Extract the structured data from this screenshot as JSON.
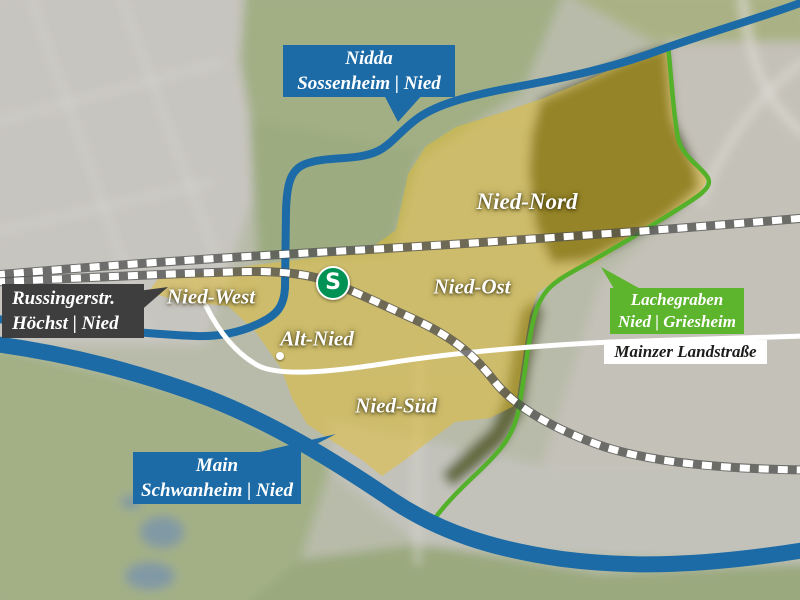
{
  "map": {
    "districts": [
      {
        "name": "Nied-Nord"
      },
      {
        "name": "Nied-Ost"
      },
      {
        "name": "Nied-West"
      },
      {
        "name": "Alt-Nied"
      },
      {
        "name": "Nied-Süd"
      }
    ],
    "callouts": {
      "nidda": {
        "line1": "Nidda",
        "line2": "Sossenheim | Nied"
      },
      "russingerstr": {
        "line1": "Russingerstr.",
        "line2": "Höchst | Nied"
      },
      "lachegraben": {
        "line1": "Lachegraben",
        "line2": "Nied | Griesheim"
      },
      "main": {
        "line1": "Main",
        "line2": "Schwanheim | Nied"
      }
    },
    "road_label": "Mainzer Landstraße",
    "sbahn_symbol": "S",
    "colors": {
      "callout_blue": "#1c6ba6",
      "callout_dark_gray": "#3e3e3e",
      "callout_green": "#5db42d",
      "road_label_background": "#ffffff",
      "sbahn_green": "#009254",
      "district_highlight_yellow": "#e3bd2e",
      "river_blue": "#1c6ba6",
      "boundary_green": "#53b12a",
      "railway_dash_white": "#ffffff"
    }
  }
}
